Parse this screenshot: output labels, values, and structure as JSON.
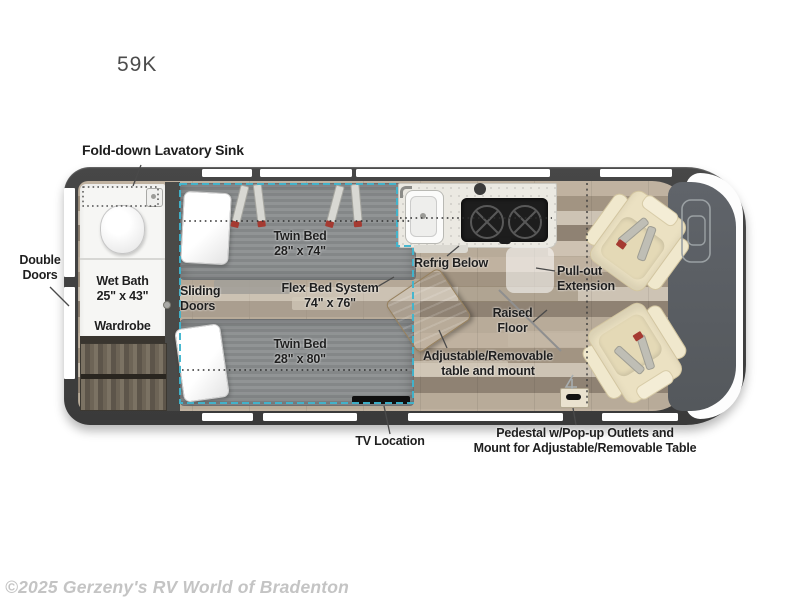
{
  "title": "59K",
  "watermark": "©2025 Gerzeny's RV World of Bradenton",
  "colors": {
    "van_body": "#3f3f3f",
    "flex_bed_outline": "#3fb5cf",
    "label_text": "#1f1f1f",
    "chair": "#ebe1c2",
    "mattress": "#8b8e90",
    "table_wood": "#c2a882",
    "watermark_gray": "#c4c4c4"
  },
  "labels": {
    "fold_down_sink": "Fold-down Lavatory Sink",
    "double_doors_1": "Double",
    "double_doors_2": "Doors",
    "wet_bath_1": "Wet Bath",
    "wet_bath_2": "25\" x 43\"",
    "wardrobe": "Wardrobe",
    "sliding_doors_1": "Sliding",
    "sliding_doors_2": "Doors",
    "twin_bed_top_1": "Twin Bed",
    "twin_bed_top_2": "28\" x 74\"",
    "flex_bed_1": "Flex Bed System",
    "flex_bed_2": "74\" x 76\"",
    "twin_bed_bottom_1": "Twin Bed",
    "twin_bed_bottom_2": "28\" x 80\"",
    "refrig_below": "Refrig Below",
    "pull_out_1": "Pull-out",
    "pull_out_2": "Extension",
    "raised_floor_1": "Raised",
    "raised_floor_2": "Floor",
    "adjustable_table_1": "Adjustable/Removable",
    "adjustable_table_2": "table and mount",
    "tv_location": "TV Location",
    "pedestal_1": "Pedestal w/Pop-up Outlets and",
    "pedestal_2": "Mount for Adjustable/Removable Table"
  }
}
